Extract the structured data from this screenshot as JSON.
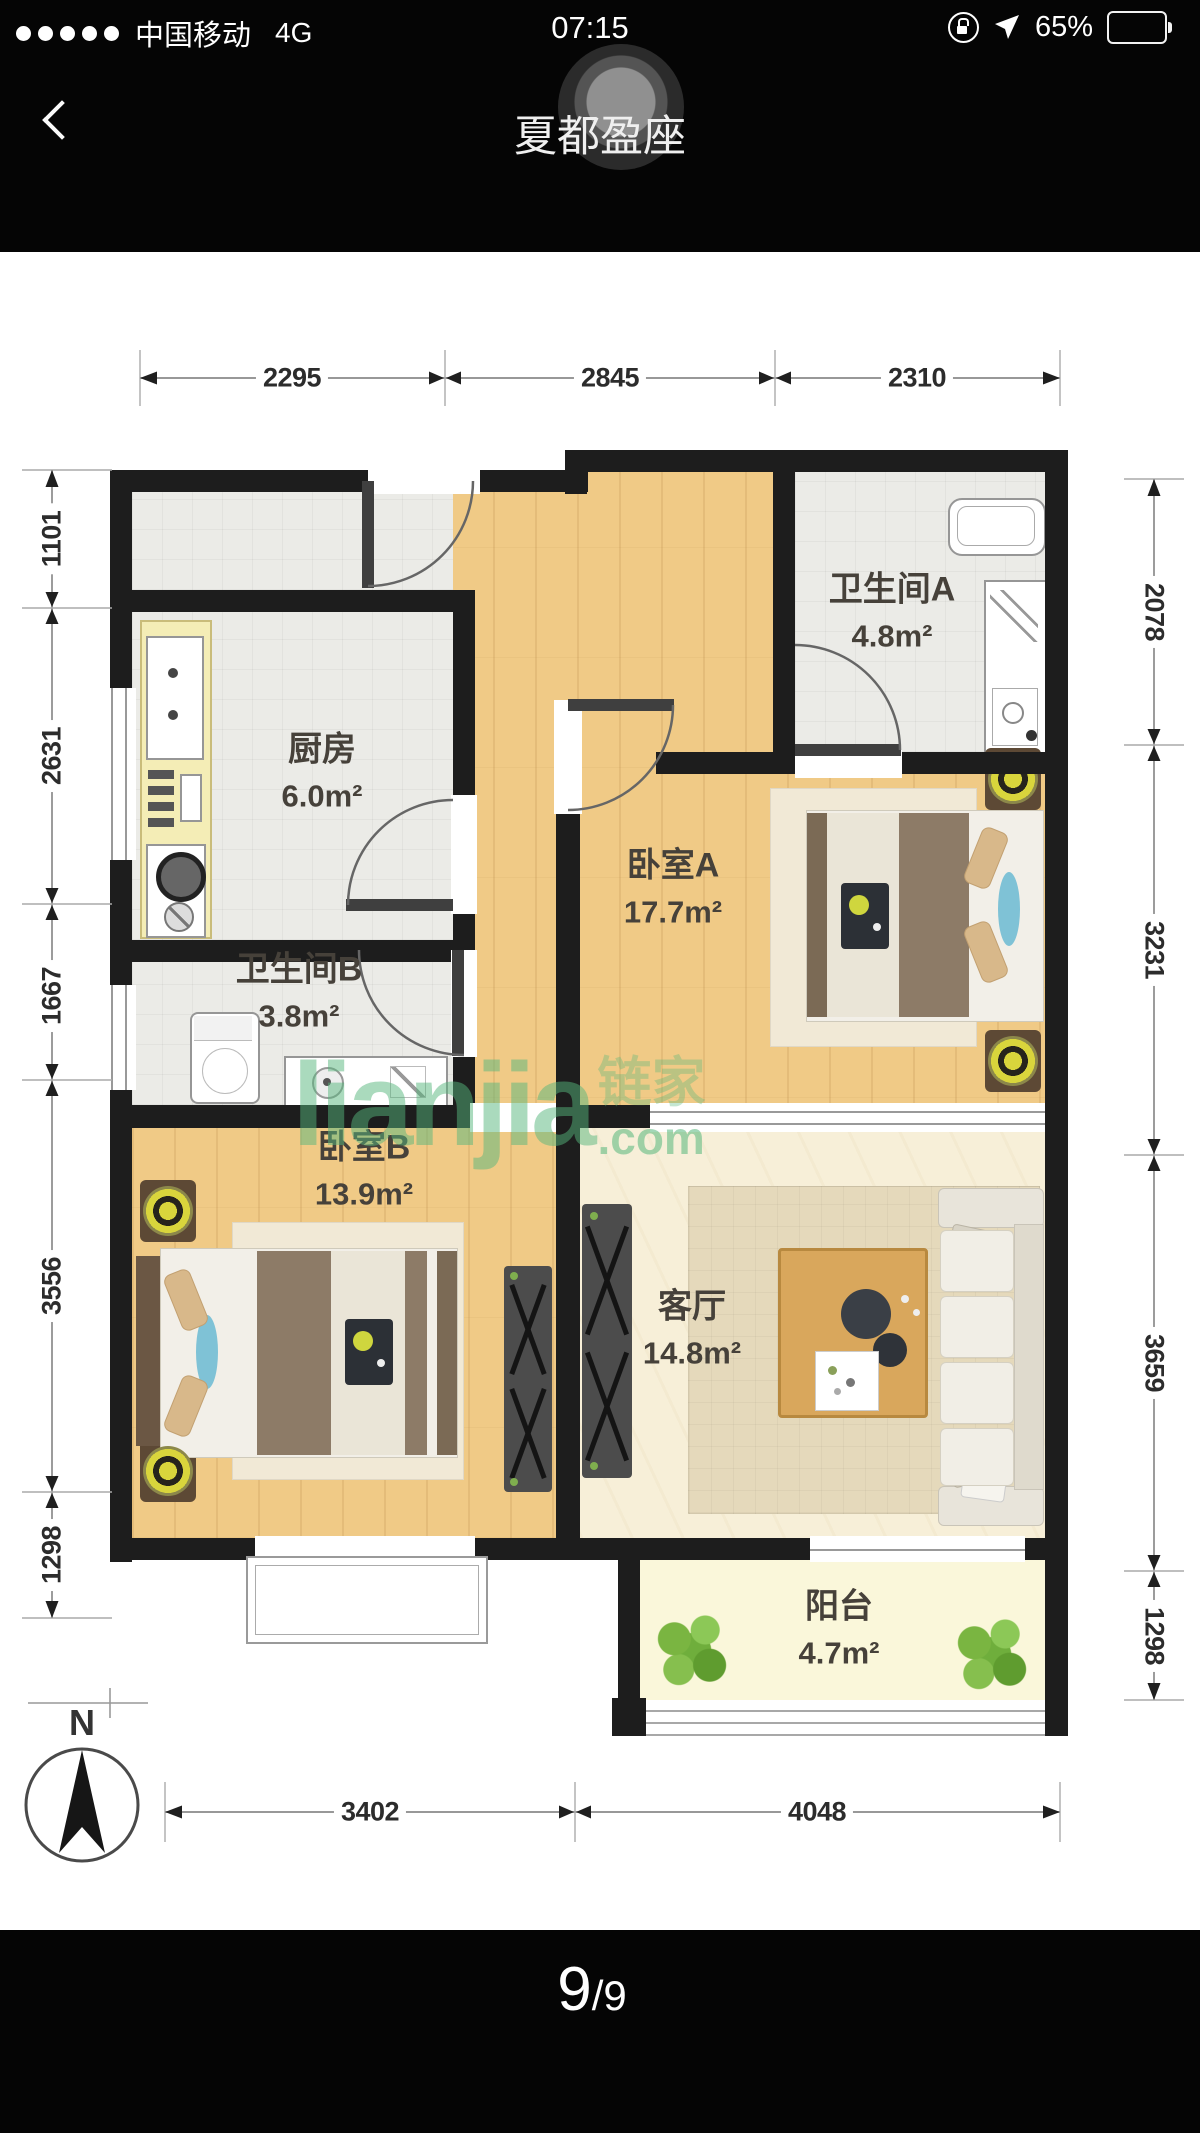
{
  "statusbar": {
    "carrier": "中国移动",
    "network": "4G",
    "time": "07:15",
    "battery_pct": "65%"
  },
  "nav": {
    "title": "夏都盈座"
  },
  "floorplan": {
    "rooms": {
      "bathA": {
        "name": "卫生间A",
        "area": "4.8m²"
      },
      "kitchen": {
        "name": "厨房",
        "area": "6.0m²"
      },
      "bedroomA": {
        "name": "卧室A",
        "area": "17.7m²"
      },
      "bathB": {
        "name": "卫生间B",
        "area": "3.8m²"
      },
      "bedroomB": {
        "name": "卧室B",
        "area": "13.9m²"
      },
      "living": {
        "name": "客厅",
        "area": "14.8m²"
      },
      "balcony": {
        "name": "阳台",
        "area": "4.7m²"
      }
    },
    "dims": {
      "top": [
        "2295",
        "2845",
        "2310"
      ],
      "left": [
        "1101",
        "2631",
        "1667",
        "3556",
        "1298"
      ],
      "right": [
        "2078",
        "3231",
        "3659",
        "1298"
      ],
      "bottom": [
        "3402",
        "4048"
      ]
    },
    "compass": {
      "label": "N"
    },
    "watermark": {
      "brand": "lianjia",
      "suffix": ".com",
      "cn": "链家"
    }
  },
  "pager": {
    "current": "9",
    "sep": "/",
    "total": "9"
  },
  "colors": {
    "wall": "#1d1d1d",
    "wood": "#f0ca86",
    "watermark_green": "#56b67c",
    "header": "#050505"
  }
}
